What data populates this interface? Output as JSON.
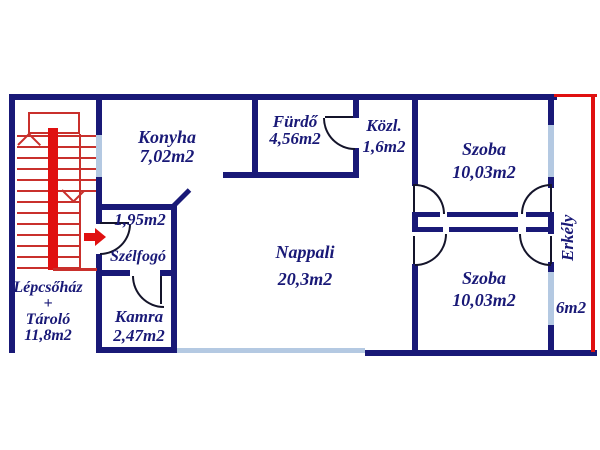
{
  "colors": {
    "wall": "#191977",
    "window": "#b4c9e2",
    "stairs": "#c9302c",
    "stairs_accent": "#e01010",
    "door_swing": "#14142a",
    "balcony_outline": "#e01010",
    "background": "#ffffff",
    "text": "#191977"
  },
  "rooms": {
    "konyha": {
      "name": "Konyha",
      "area": "7,02m2"
    },
    "furdo": {
      "name": "Fürdő",
      "area": "4,56m2"
    },
    "kozl": {
      "name": "Közl.",
      "area": "1,6m2"
    },
    "szoba_felso": {
      "name": "Szoba",
      "area": "10,03m2"
    },
    "nappali": {
      "name": "Nappali",
      "area": "20,3m2"
    },
    "szelfogo": {
      "name": "Szélfogó",
      "area": "1,95m2"
    },
    "kamra": {
      "name": "Kamra",
      "area": "2,47m2"
    },
    "lepcsohaz_tarolo": {
      "line1": "Lépcsőház",
      "plus": "+",
      "line2": "Tároló",
      "area": "11,8m2"
    },
    "szoba_also": {
      "name": "Szoba",
      "area": "10,03m2"
    },
    "erkely": {
      "name": "Erkély",
      "area": "6m2"
    }
  }
}
